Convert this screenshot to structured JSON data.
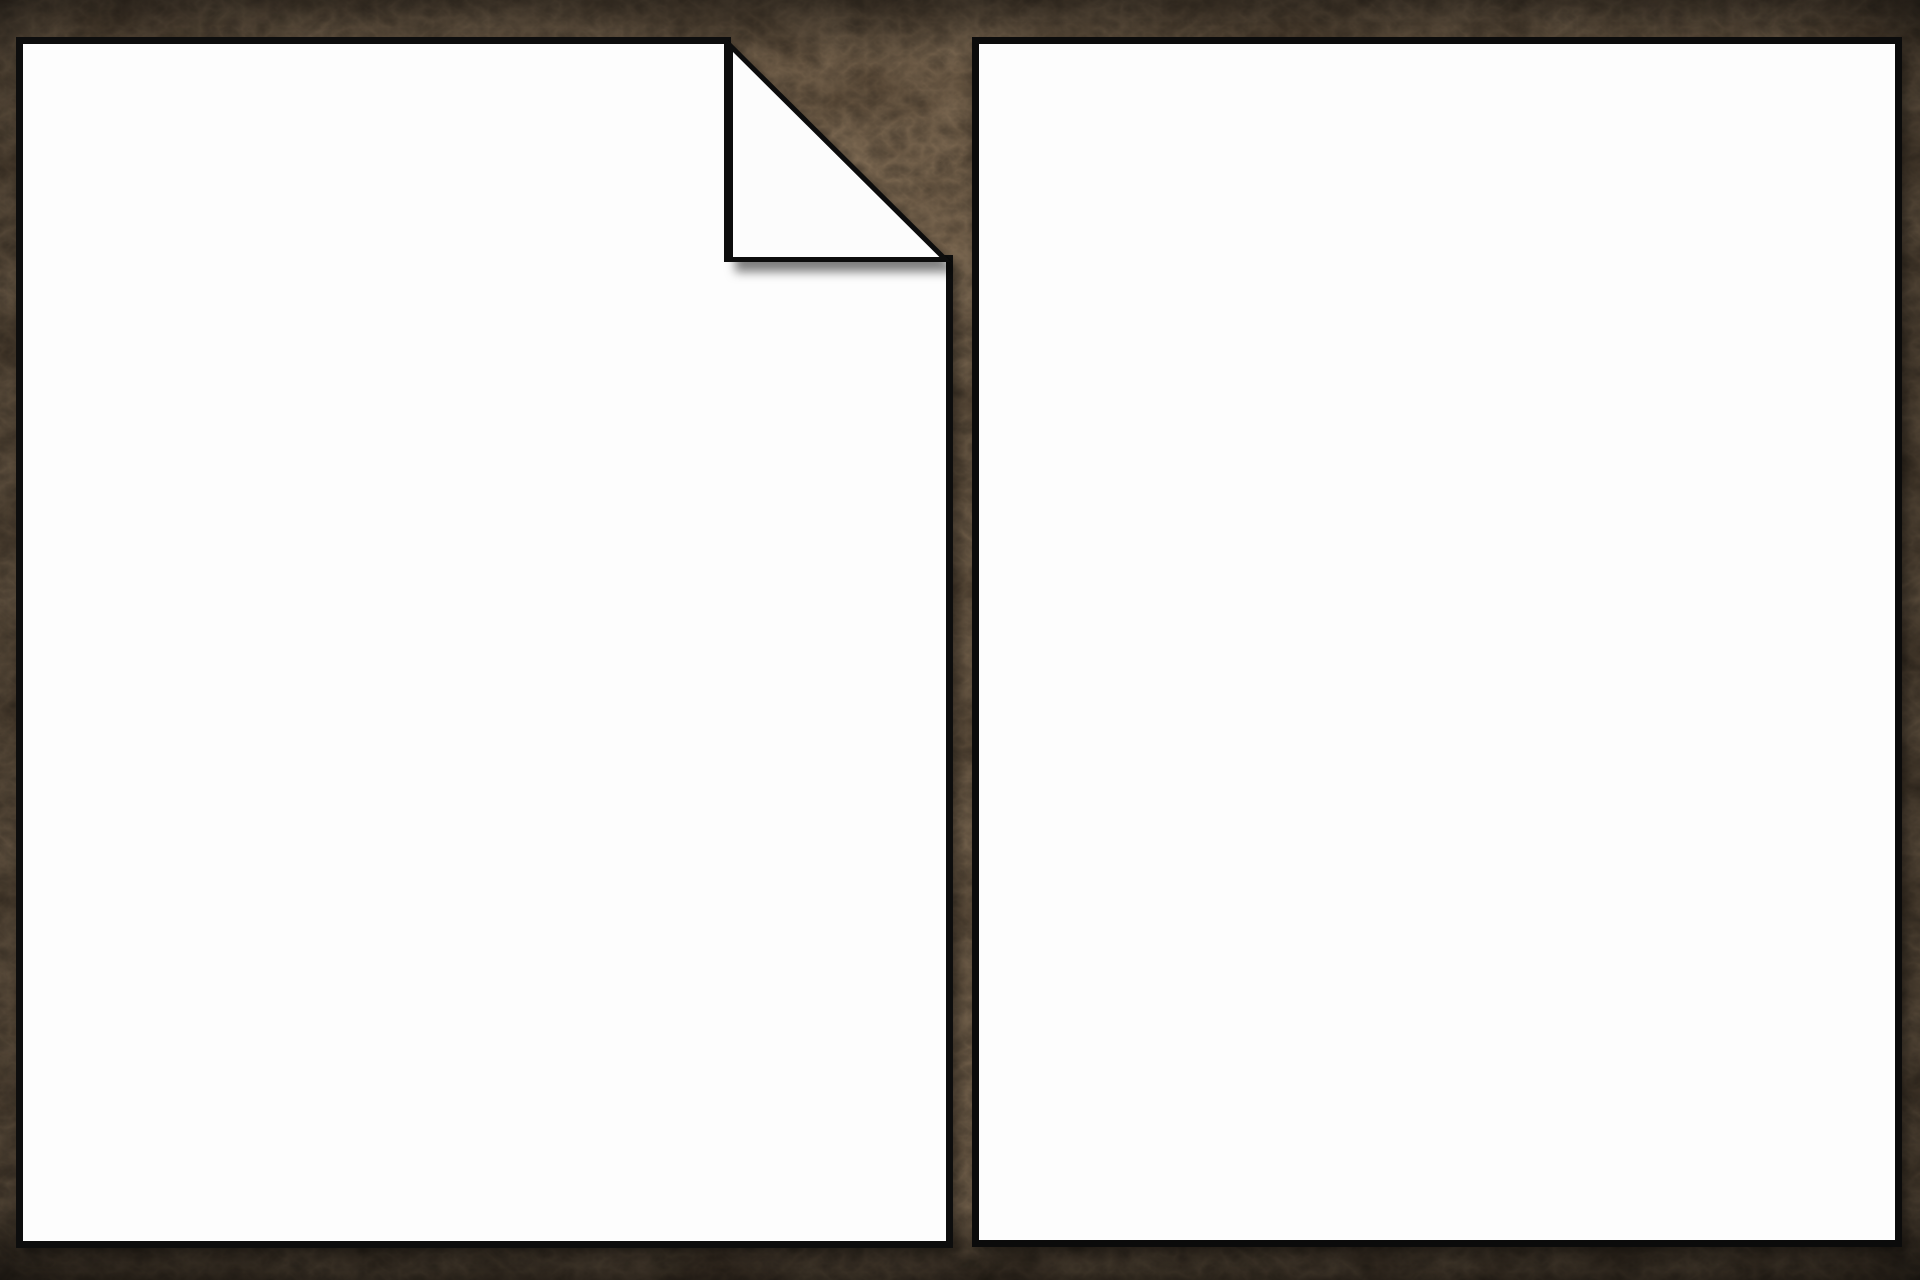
{
  "scene": {
    "description": "Two blank white album pages lying side by side on a dark brown leather desk background",
    "background_base_color": "#291c10",
    "background_shadow_color": "#120b06",
    "paper_color": "#fdfdfd",
    "page_border_color": "#0b0b0b"
  },
  "pages": {
    "left": {
      "content": "",
      "folded_corner": "top-right"
    },
    "right": {
      "content": ""
    }
  }
}
